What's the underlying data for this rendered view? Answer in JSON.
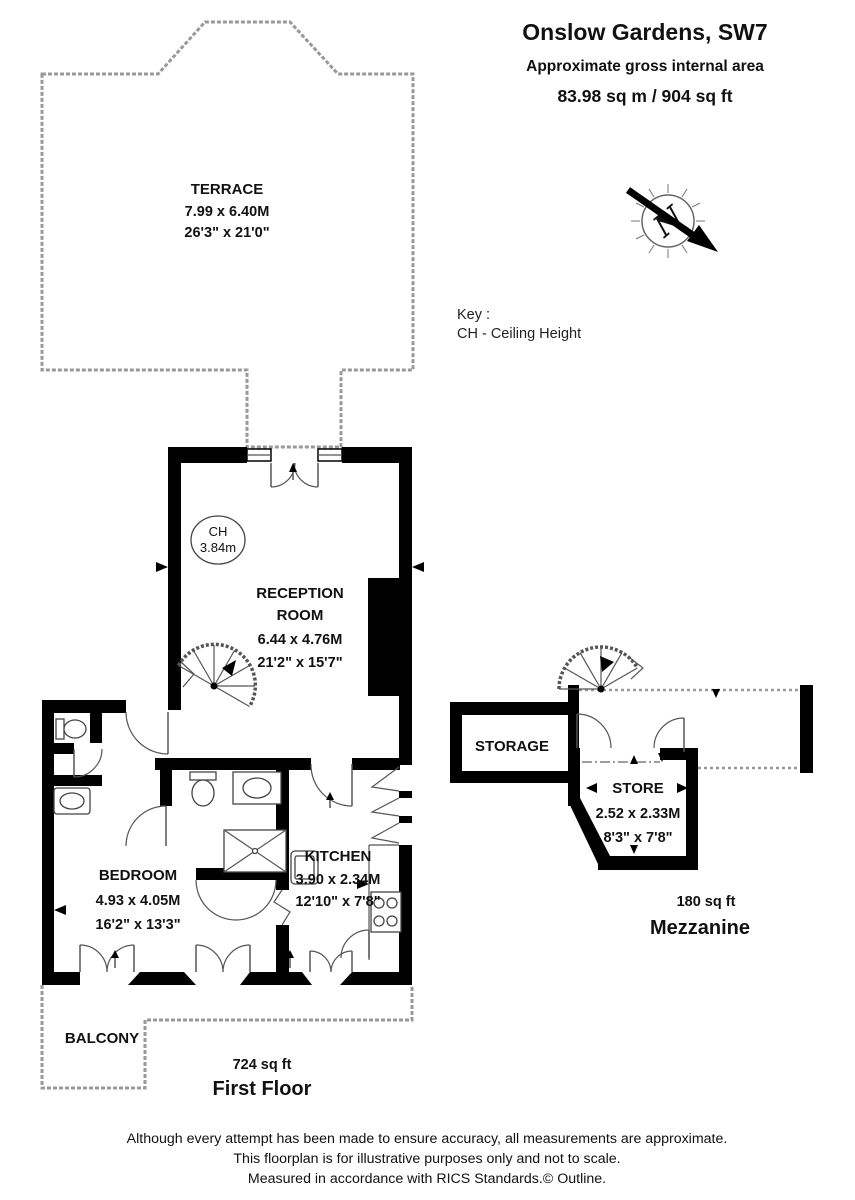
{
  "title": {
    "property": "Onslow Gardens, SW7",
    "subtitle": "Approximate gross internal area",
    "area": "83.98 sq m / 904 sq ft"
  },
  "key": {
    "heading": "Key :",
    "ceiling_height": "CH - Ceiling Height"
  },
  "compass": {
    "north": "N"
  },
  "ceiling_height_badge": {
    "label": "CH",
    "value": "3.84m"
  },
  "rooms": {
    "terrace": {
      "name": "TERRACE",
      "metric": "7.99 x 6.40M",
      "imperial": "26'3\" x 21'0\""
    },
    "reception": {
      "line1": "RECEPTION",
      "line2": "ROOM",
      "metric": "6.44 x 4.76M",
      "imperial": "21'2\" x 15'7\""
    },
    "bedroom": {
      "name": "BEDROOM",
      "metric": "4.93 x 4.05M",
      "imperial": "16'2\" x 13'3\""
    },
    "kitchen": {
      "name": "KITCHEN",
      "metric": "3.90 x 2.34M",
      "imperial": "12'10\" x 7'8\""
    },
    "storage": {
      "name": "STORAGE"
    },
    "store": {
      "name": "STORE",
      "metric": "2.52 x 2.33M",
      "imperial": "8'3\" x 7'8\""
    },
    "balcony": {
      "name": "BALCONY"
    }
  },
  "floors": {
    "first": {
      "area": "724 sq ft",
      "name": "First Floor"
    },
    "mezzanine": {
      "area": "180 sq ft",
      "name": "Mezzanine"
    }
  },
  "disclaimer": [
    "Although every attempt has been made to ensure accuracy, all measurements are approximate.",
    "This floorplan is for illustrative purposes only and not to scale.",
    "Measured in accordance with RICS Standards.© Outline."
  ]
}
